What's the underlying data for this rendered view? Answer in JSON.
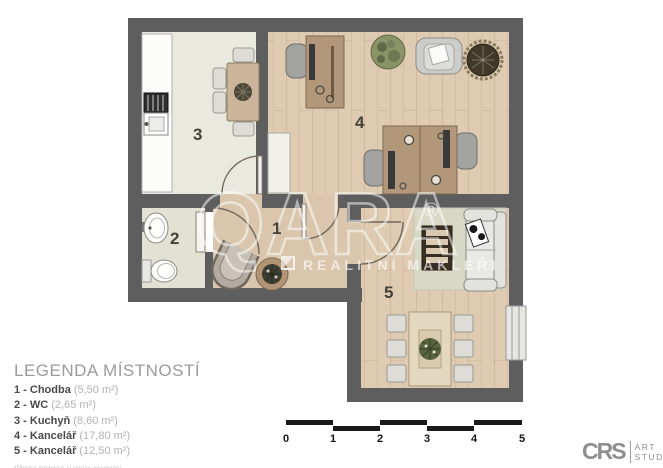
{
  "watermark": {
    "brand": "QARA",
    "registered": "®",
    "tagline": "REALITNÍ MAKLÉŘI"
  },
  "rooms": {
    "r1": "1",
    "r2": "2",
    "r3": "3",
    "r4": "4",
    "r5": "5"
  },
  "legend": {
    "title": "LEGENDA MÍSTNOSTÍ",
    "items": [
      {
        "label": "1 - Chodba",
        "area": "(5,50 m²)"
      },
      {
        "label": "2 - WC",
        "area": "(2,65 m²)"
      },
      {
        "label": "3 - Kuchyň",
        "area": "(8,60 m²)"
      },
      {
        "label": "4 - Kancelář",
        "area": "(17,80 m²)"
      },
      {
        "label": "5 - Kancelář",
        "area": "(12,50 m²)"
      }
    ],
    "footnote": "*Plocha místností je pouze orientační"
  },
  "scale": {
    "labels": [
      "0",
      "1",
      "2",
      "3",
      "4",
      "5"
    ]
  },
  "logo": {
    "initials": "CRS",
    "line1": "ART",
    "line2": "STUDIO"
  },
  "theme": {
    "wall": "#5e5e5e",
    "wood": "#decbb2",
    "kitchen": "#eae9e0",
    "wc": "#e1e2d3",
    "hall": "#dac6ad",
    "rug": "#d8d8c7",
    "desk": "#b2977b",
    "scale": "#1a1a1a",
    "legend-title": "#9b9b9b",
    "legend-text": "#4a4a4a",
    "legend-area": "#b3b3b3"
  }
}
